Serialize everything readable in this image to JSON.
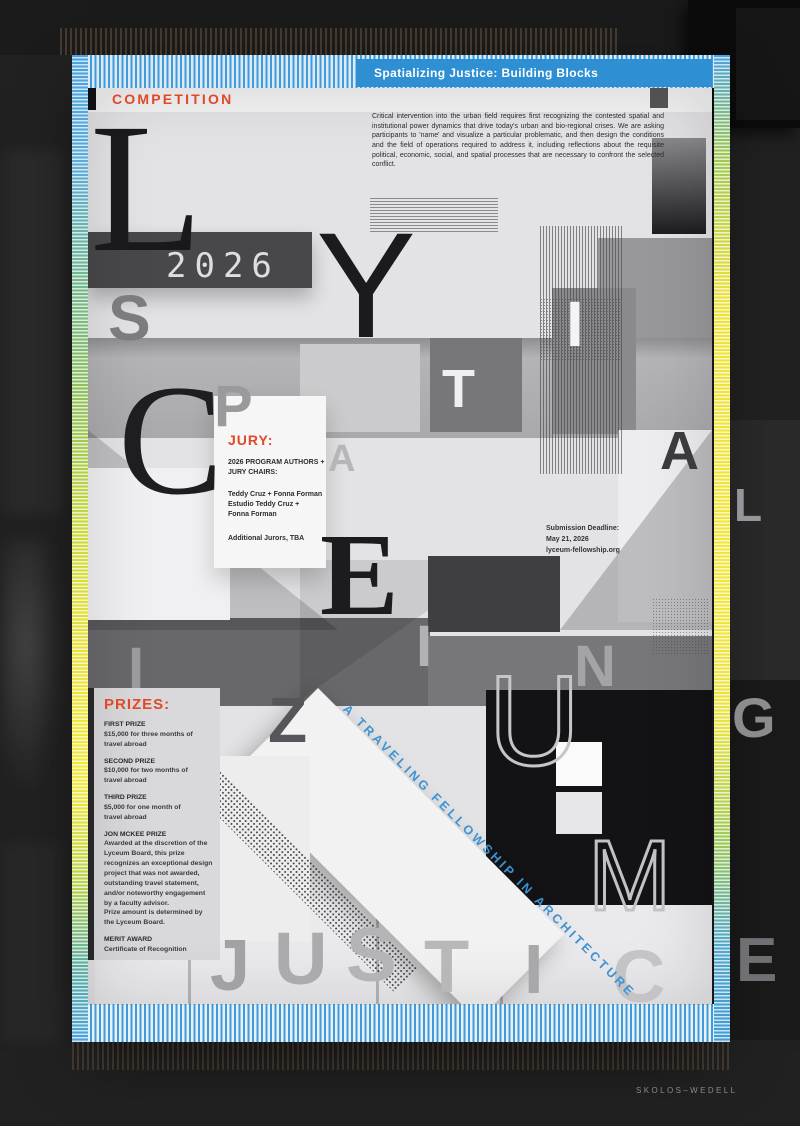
{
  "banner": {
    "title": "Spatializing Justice: Building Blocks"
  },
  "competition_label": "COMPETITION",
  "intro": "Critical intervention into the urban field requires first recognizing the contested spatial and institutional power dynamics that drive today's urban and bio-regional crises. We are asking participants to 'name' and visualize a particular problematic, and then design the conditions and the field of operations required to address it, including reflections about the requisite political, economic, social, and spatial processes that are necessary to confront the selected conflict.",
  "year": "2026",
  "jury": {
    "heading": "JURY:",
    "subheading": "2026 Program Authors + Jury Chairs:",
    "names": "Teddy Cruz + Fonna Forman\nEstudio Teddy Cruz +\nFonna Forman",
    "additional": "Additional Jurors, TBA"
  },
  "submission": {
    "label": "Submission Deadline:",
    "date": "May 21, 2026",
    "url": "lyceum-fellowship.org"
  },
  "prizes": {
    "heading": "PRIZES:",
    "items": [
      {
        "title": "FIRST PRIZE",
        "desc": "$15,000 for three months of\ntravel abroad"
      },
      {
        "title": "SECOND PRIZE",
        "desc": "$10,000 for two months of\ntravel abroad"
      },
      {
        "title": "THIRD PRIZE",
        "desc": "$5,000 for one month of\ntravel abroad"
      },
      {
        "title": "JON MCKEE PRIZE",
        "desc": "Awarded at the discretion of the Lyceum Board, this prize recognizes an exceptional design project that was not awarded, outstanding travel statement, and/or noteworthy engagement by a faculty advisor.\nPrize amount is determined by the Lyceum Board."
      },
      {
        "title": "MERIT AWARD",
        "desc": "Certificate of Recognition"
      }
    ]
  },
  "tagline": "A TRAVELING FELLOWSHIP IN ARCHITECTURE",
  "credit": "SKOLOS–WEDELL",
  "colors": {
    "accent_red": "#e04828",
    "banner_blue": "#2e8fd2",
    "tagline_blue": "#3d92d2",
    "border_yellow": "#f0e33c",
    "border_green": "#7dbd66",
    "border_blue": "#3f9bd9"
  },
  "letters": [
    {
      "ch": "L",
      "x": 90,
      "y": 96,
      "s": 185,
      "c": "#19191b",
      "f": "serif",
      "w": 400
    },
    {
      "ch": "Y",
      "x": 316,
      "y": 210,
      "s": 150,
      "c": "#1b1b1d",
      "f": "sans",
      "w": 400
    },
    {
      "ch": "S",
      "x": 108,
      "y": 286,
      "s": 64,
      "c": "#7c7c80",
      "f": "sans",
      "w": 700
    },
    {
      "ch": "I",
      "x": 566,
      "y": 292,
      "s": 64,
      "c": "#f4f4f6",
      "f": "sans",
      "w": 700
    },
    {
      "ch": "T",
      "x": 442,
      "y": 362,
      "s": 54,
      "c": "#efeff1",
      "f": "sans",
      "w": 700
    },
    {
      "ch": "C",
      "x": 118,
      "y": 362,
      "s": 158,
      "c": "#1e1e20",
      "f": "serif",
      "w": 400
    },
    {
      "ch": "P",
      "x": 214,
      "y": 378,
      "s": 58,
      "c": "#9a9a9c",
      "f": "sans",
      "w": 700
    },
    {
      "ch": "A",
      "x": 328,
      "y": 440,
      "s": 38,
      "c": "#b6b6b8",
      "f": "sans",
      "w": 700
    },
    {
      "ch": "A",
      "x": 660,
      "y": 424,
      "s": 54,
      "c": "#3b3b3d",
      "f": "sans",
      "w": 700
    },
    {
      "ch": "E",
      "x": 320,
      "y": 516,
      "s": 118,
      "c": "#1c1c1e",
      "f": "serif",
      "w": 700
    },
    {
      "ch": "L",
      "x": 734,
      "y": 482,
      "s": 46,
      "c": "#96969a",
      "f": "sans",
      "w": 700
    },
    {
      "ch": "I",
      "x": 128,
      "y": 640,
      "s": 58,
      "c": "#9a9a9e",
      "f": "sans",
      "w": 700
    },
    {
      "ch": "I",
      "x": 416,
      "y": 618,
      "s": 58,
      "c": "#b2b2b4",
      "f": "sans",
      "w": 700
    },
    {
      "ch": "N",
      "x": 574,
      "y": 638,
      "s": 58,
      "c": "#a4a4a6",
      "f": "sans",
      "w": 700
    },
    {
      "ch": "G",
      "x": 732,
      "y": 690,
      "s": 56,
      "c": "#8c8c8e",
      "f": "sans",
      "w": 700
    },
    {
      "ch": "Z",
      "x": 268,
      "y": 688,
      "s": 64,
      "c": "#55555a",
      "f": "sans",
      "w": 700
    },
    {
      "ch": "U",
      "x": 488,
      "y": 658,
      "s": 128,
      "c": "#c6c6c8",
      "f": "sans",
      "w": 400,
      "st": true,
      "sw": 3
    },
    {
      "ch": "M",
      "x": 588,
      "y": 826,
      "s": 100,
      "c": "#c2c2c4",
      "f": "sans",
      "w": 400,
      "st": true,
      "sw": 3
    },
    {
      "ch": "J",
      "x": 210,
      "y": 930,
      "s": 72,
      "c": "#a2a2a4",
      "f": "sans",
      "w": 700
    },
    {
      "ch": "U",
      "x": 274,
      "y": 922,
      "s": 74,
      "c": "#ababad",
      "f": "sans",
      "w": 700
    },
    {
      "ch": "S",
      "x": 346,
      "y": 918,
      "s": 76,
      "c": "#b4b4b6",
      "f": "sans",
      "w": 700
    },
    {
      "ch": "T",
      "x": 424,
      "y": 930,
      "s": 74,
      "c": "#b8b8ba",
      "f": "sans",
      "w": 700
    },
    {
      "ch": "I",
      "x": 524,
      "y": 934,
      "s": 70,
      "c": "#a8a8aa",
      "f": "sans",
      "w": 700
    },
    {
      "ch": "C",
      "x": 612,
      "y": 940,
      "s": 74,
      "c": "#c4c4c6",
      "f": "sans",
      "w": 700
    },
    {
      "ch": "E",
      "x": 736,
      "y": 930,
      "s": 62,
      "c": "#707074",
      "f": "sans",
      "w": 700
    }
  ]
}
